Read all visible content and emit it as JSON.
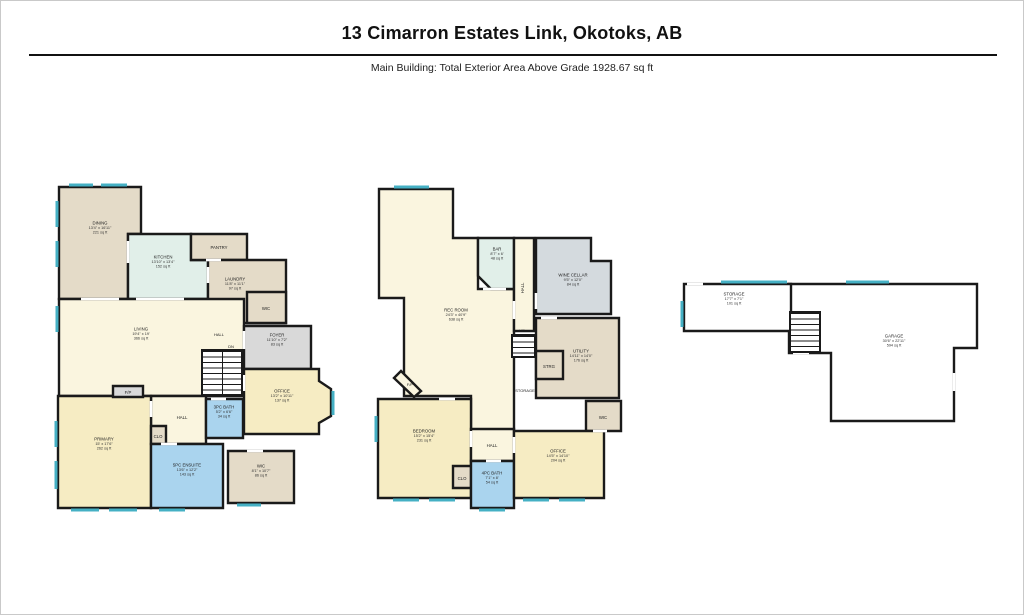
{
  "header": {
    "title": "13 Cimarron Estates Link, Okotoks, AB",
    "subtitle": "Main Building: Total Exterior Area Above Grade 1928.67 sq ft"
  },
  "palette": {
    "wall": "#1a1a1a",
    "window": "#45b0c4",
    "door_gap": "#ffffff",
    "cream": "#faf5df",
    "yellow": "#f6ecc3",
    "tan": "#e4dbc8",
    "green": "#e1efe9",
    "blue": "#aad4ee",
    "gray": "#d9d9d9",
    "bluegray": "#d4dade",
    "white": "#ffffff"
  },
  "floors": {
    "main": {
      "rooms": {
        "dining": {
          "name": "DINING",
          "dims": "13'4\" x 16'11\"",
          "area": "221 sq ft"
        },
        "kitchen": {
          "name": "KITCHEN",
          "dims": "13'10\" x 13'4\"",
          "area": "152 sq ft"
        },
        "pantry": {
          "name": "PANTRY"
        },
        "laundry": {
          "name": "LAUNDRY",
          "dims": "11'8\" x 11'1\"",
          "area": "97 sq ft"
        },
        "wic_upper": {
          "name": "WIC"
        },
        "living": {
          "name": "LIVING",
          "dims": "19'4\" x 19'",
          "area": "366 sq ft"
        },
        "foyer": {
          "name": "FOYER",
          "dims": "11'10\" x 7'2\"",
          "area": "83 sq ft"
        },
        "office": {
          "name": "OFFICE",
          "dims": "13'2\" x 10'11\"",
          "area": "137 sq ft"
        },
        "hall_small": {
          "name": "HALL"
        },
        "primary": {
          "name": "PRIMARY",
          "dims": "15' x 17'6\"",
          "area": "262 sq ft"
        },
        "clo": {
          "name": "CLO"
        },
        "bath3": {
          "name": "3PC BATH",
          "dims": "5'2\" x 6'6\"",
          "area": "34 sq ft"
        },
        "ensuite": {
          "name": "5PC ENSUITE",
          "dims": "13'6\" x 12'2\"",
          "area": "143 sq ft"
        },
        "wic_lower": {
          "name": "WIC",
          "dims": "8'1\" x 10'7\"",
          "area": "86 sq ft"
        },
        "fp": {
          "name": "F/P"
        }
      },
      "labels": {
        "hall_upper": "HALL",
        "dn": "DN"
      }
    },
    "basement": {
      "rooms": {
        "rec": {
          "name": "REC ROOM",
          "dims": "24'3\" x 40'9\"",
          "area": "638 sq ft"
        },
        "bar": {
          "name": "BAR",
          "dims": "8'7\" x 6'",
          "area": "48 sq ft"
        },
        "hall_strip": {
          "name": "HALL"
        },
        "wine": {
          "name": "WINE CELLAR",
          "dims": "9'5\" x 12'0\"",
          "area": "84 sq ft"
        },
        "utility": {
          "name": "UTILITY",
          "dims": "14'11\" x 14'0\"",
          "area": "176 sq ft"
        },
        "strg": {
          "name": "STRG"
        },
        "wic": {
          "name": "WIC"
        },
        "bedroom": {
          "name": "BEDROOM",
          "dims": "15'2\" x 15'4\"",
          "area": "231 sq ft"
        },
        "hall2": {
          "name": "HALL"
        },
        "clo": {
          "name": "CLO"
        },
        "bath4": {
          "name": "4PC BATH",
          "dims": "7'1\" x 8'",
          "area": "54 sq ft"
        },
        "office": {
          "name": "OFFICE",
          "dims": "14'5\" x 14'10\"",
          "area": "204 sq ft"
        }
      },
      "labels": {
        "up": "UP",
        "storage_lbl": "STORAGE",
        "fp": "F/P"
      }
    },
    "garage": {
      "rooms": {
        "storage": {
          "name": "STORAGE",
          "dims": "17'7\" x 7'1\"",
          "area": "101 sq ft"
        },
        "garage": {
          "name": "GARAGE",
          "dims": "30'6\" x 22'11\"",
          "area": "594 sq ft"
        }
      },
      "labels": {}
    }
  }
}
